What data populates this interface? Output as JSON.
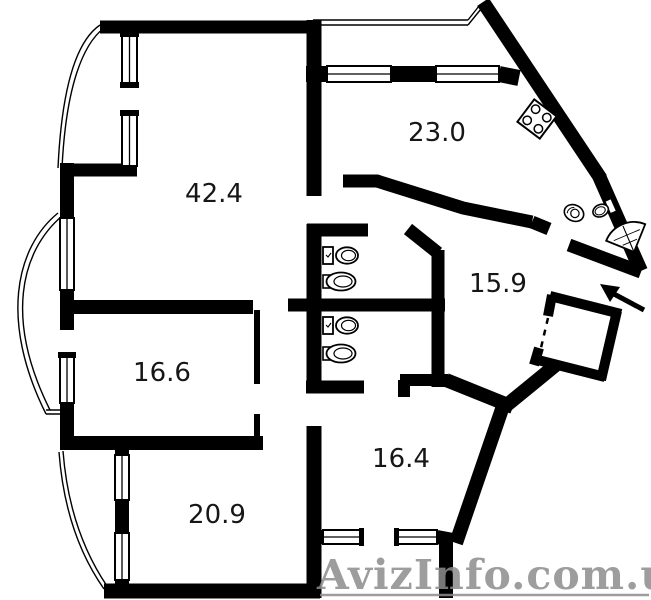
{
  "title": "apartment-floor-plan",
  "rooms": [
    {
      "name": "living-room",
      "area": "42.4"
    },
    {
      "name": "kitchen",
      "area": "23.0"
    },
    {
      "name": "hallway",
      "area": "15.9"
    },
    {
      "name": "room-left",
      "area": "16.6"
    },
    {
      "name": "room-bottom-center",
      "area": "16.4"
    },
    {
      "name": "room-bottom-left",
      "area": "20.9"
    }
  ],
  "watermark": {
    "text": "AvizInfo.com.ua",
    "color": "#8d8d8d"
  },
  "colors": {
    "wall": "#000000",
    "background": "#ffffff",
    "label": "#161616"
  },
  "fixtures": [
    "stove",
    "toilet",
    "sink",
    "corner-shower",
    "entrance-arrow",
    "windows",
    "balcony-curves"
  ]
}
